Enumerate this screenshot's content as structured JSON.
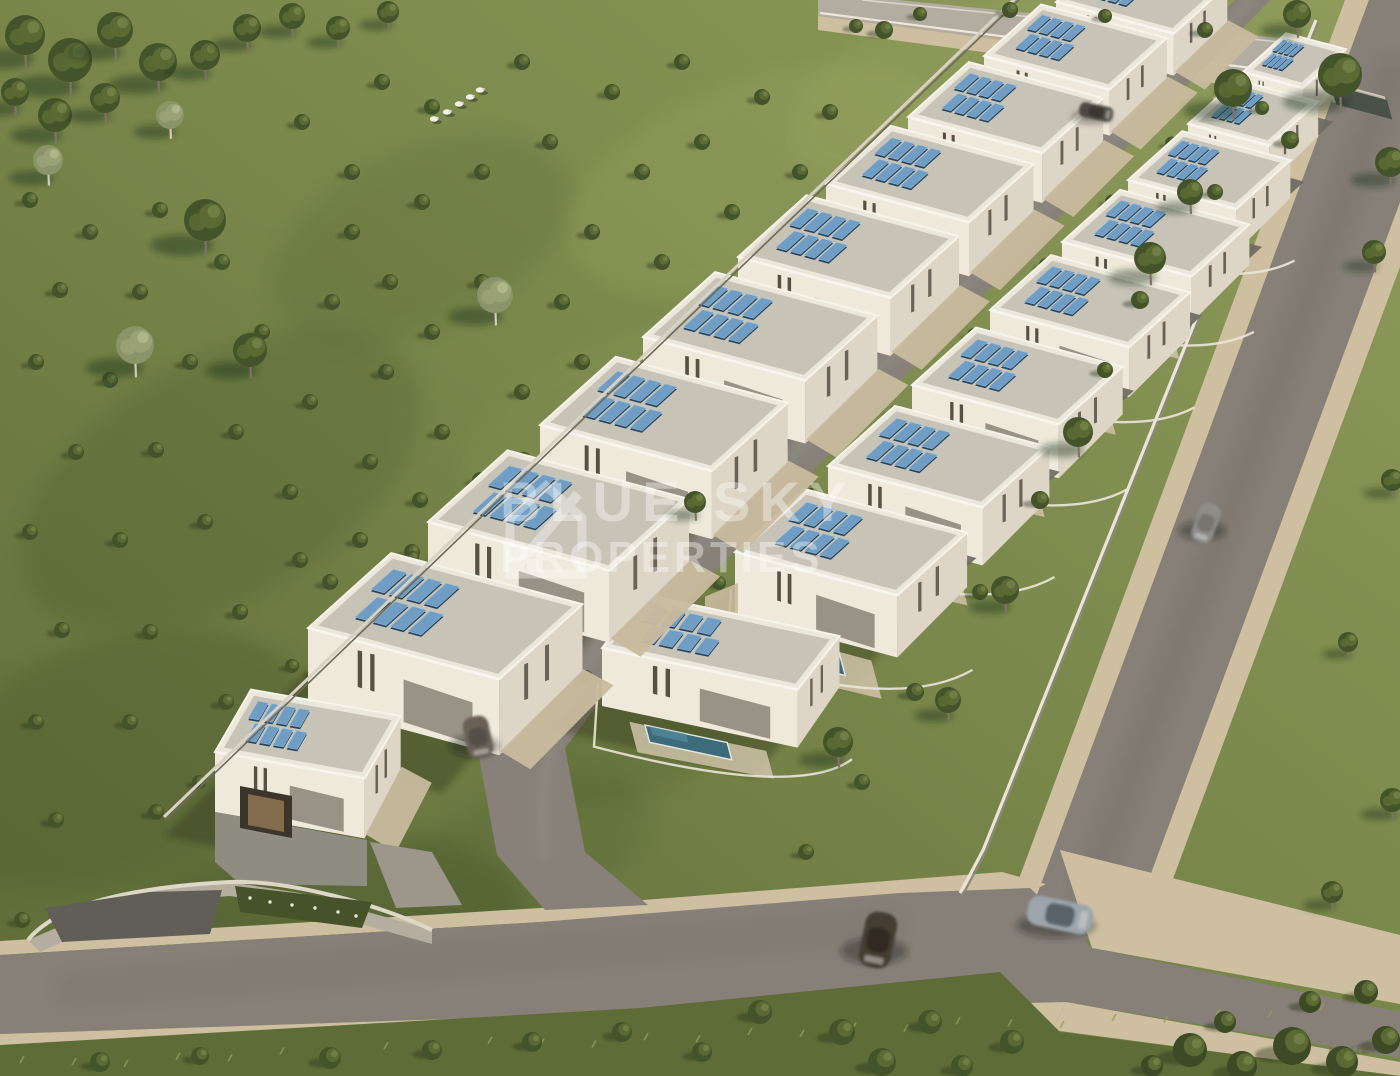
{
  "watermark": {
    "line1": "BLUE SKY",
    "line2": "PROPERTIES",
    "signature": "Uo /12"
  },
  "scene": {
    "colors": {
      "grass": "#7b894c",
      "grass_dark": "#55652f",
      "grass_light": "#97a263",
      "asphalt": "#868078",
      "asphalt_dark": "#746e66",
      "top_road": "#b3ada1",
      "sidewalk": "#cdbfa0",
      "driveway": "#c8bb9e",
      "facade": "#efe9db",
      "facade_side": "#ddd5c6",
      "roof_inner": "#c7c3b7",
      "parapet": "#f6f3eb",
      "solar_dark": "#26455f",
      "solar_light": "#6f9dc4",
      "pool": "#3c6b7c",
      "pool_light": "#5791a2",
      "wall": "#eae5d8",
      "shadow": "rgba(44,52,30,0.38)",
      "window": "#575044",
      "glass": "#7c766b",
      "tree_dark": "#44542a",
      "tree_mid": "#5b6a33",
      "tree_light": "#74834a",
      "birch": "#9aa275"
    },
    "villas_left": [
      {
        "x": 215,
        "y": 752,
        "L": 152,
        "S": 72,
        "h": 60,
        "au": -60,
        "av": 10,
        "corner": true
      },
      {
        "x": 308,
        "y": 628,
        "L": 198,
        "S": 112,
        "h": 76
      },
      {
        "x": 428,
        "y": 522,
        "L": 188,
        "S": 107,
        "h": 72
      },
      {
        "x": 540,
        "y": 425,
        "L": 178,
        "S": 102,
        "h": 68
      },
      {
        "x": 643,
        "y": 337,
        "L": 168,
        "S": 97,
        "h": 63
      },
      {
        "x": 738,
        "y": 257,
        "L": 158,
        "S": 92,
        "h": 58
      },
      {
        "x": 826,
        "y": 184,
        "L": 148,
        "S": 87,
        "h": 54
      },
      {
        "x": 908,
        "y": 117,
        "L": 139,
        "S": 82,
        "h": 50
      },
      {
        "x": 984,
        "y": 56,
        "L": 130,
        "S": 77,
        "h": 46
      },
      {
        "x": 1056,
        "y": 2,
        "L": 122,
        "S": 72,
        "h": 42
      }
    ],
    "villas_right": [
      {
        "x": 602,
        "y": 648,
        "L": 200,
        "S": 68,
        "h": 58,
        "au": -52,
        "av": 12,
        "pool": true,
        "corner": true
      },
      {
        "x": 735,
        "y": 552,
        "L": 168,
        "S": 94,
        "h": 62,
        "pool": true
      },
      {
        "x": 828,
        "y": 466,
        "L": 160,
        "S": 90,
        "h": 58,
        "pool": true
      },
      {
        "x": 912,
        "y": 385,
        "L": 152,
        "S": 86,
        "h": 54,
        "pool": true
      },
      {
        "x": 990,
        "y": 310,
        "L": 144,
        "S": 82,
        "h": 50,
        "pool": true
      },
      {
        "x": 1062,
        "y": 242,
        "L": 134,
        "S": 78,
        "h": 46,
        "pool": true
      },
      {
        "x": 1128,
        "y": 180,
        "L": 112,
        "S": 73,
        "h": 43,
        "pool": true
      },
      {
        "x": 1188,
        "y": 124,
        "L": 84,
        "S": 66,
        "h": 39
      },
      {
        "x": 1243,
        "y": 72,
        "L": 62,
        "S": 58,
        "h": 35
      }
    ],
    "carports": [
      {
        "x": 1032,
        "y": 96
      },
      {
        "x": 958,
        "y": 170
      }
    ],
    "field_trees": [
      [
        25,
        35,
        20,
        "o"
      ],
      [
        70,
        60,
        22,
        "o"
      ],
      [
        115,
        30,
        18,
        "o"
      ],
      [
        158,
        62,
        19,
        "o"
      ],
      [
        55,
        115,
        17,
        "o"
      ],
      [
        105,
        98,
        15,
        "o"
      ],
      [
        15,
        92,
        14,
        "o"
      ],
      [
        205,
        55,
        15,
        "o"
      ],
      [
        247,
        28,
        14,
        "o"
      ],
      [
        292,
        16,
        13,
        "o"
      ],
      [
        338,
        28,
        12,
        "o"
      ],
      [
        388,
        12,
        11,
        "o"
      ],
      [
        48,
        160,
        15,
        "b"
      ],
      [
        170,
        115,
        14,
        "b"
      ],
      [
        135,
        345,
        19,
        "b"
      ],
      [
        205,
        220,
        21,
        "o"
      ],
      [
        250,
        350,
        17,
        "o"
      ],
      [
        495,
        295,
        18,
        "b"
      ],
      [
        592,
        555,
        25,
        "o"
      ]
    ],
    "garden_trees": [
      [
        1233,
        88,
        19
      ],
      [
        1190,
        192,
        13
      ],
      [
        1150,
        258,
        16
      ],
      [
        1078,
        432,
        15
      ],
      [
        1005,
        590,
        14
      ],
      [
        948,
        700,
        13
      ],
      [
        838,
        742,
        15
      ],
      [
        695,
        502,
        11
      ]
    ],
    "east_trees": [
      [
        1340,
        75,
        22
      ],
      [
        1297,
        14,
        14
      ],
      [
        1390,
        162,
        15
      ],
      [
        1374,
        252,
        12
      ],
      [
        1392,
        480,
        11
      ],
      [
        1348,
        642,
        10
      ],
      [
        1392,
        800,
        12
      ],
      [
        1332,
        892,
        11
      ]
    ],
    "field_bushes": [
      [
        30,
        200
      ],
      [
        90,
        232
      ],
      [
        160,
        210
      ],
      [
        60,
        290
      ],
      [
        140,
        292
      ],
      [
        222,
        262
      ],
      [
        36,
        362
      ],
      [
        110,
        380
      ],
      [
        190,
        362
      ],
      [
        262,
        332
      ],
      [
        332,
        302
      ],
      [
        76,
        452
      ],
      [
        156,
        450
      ],
      [
        236,
        432
      ],
      [
        310,
        402
      ],
      [
        386,
        372
      ],
      [
        30,
        532
      ],
      [
        120,
        540
      ],
      [
        205,
        522
      ],
      [
        290,
        492
      ],
      [
        370,
        462
      ],
      [
        442,
        432
      ],
      [
        62,
        630
      ],
      [
        150,
        632
      ],
      [
        240,
        612
      ],
      [
        330,
        582
      ],
      [
        412,
        552
      ],
      [
        36,
        722
      ],
      [
        130,
        722
      ],
      [
        226,
        702
      ],
      [
        320,
        672
      ],
      [
        56,
        820
      ],
      [
        156,
        812
      ],
      [
        250,
        790
      ],
      [
        22,
        920
      ],
      [
        120,
        912
      ],
      [
        352,
        172
      ],
      [
        422,
        202
      ],
      [
        482,
        172
      ],
      [
        550,
        142
      ],
      [
        432,
        107
      ],
      [
        302,
        122
      ],
      [
        382,
        82
      ],
      [
        522,
        62
      ],
      [
        612,
        92
      ],
      [
        682,
        62
      ],
      [
        762,
        97
      ],
      [
        642,
        172
      ],
      [
        702,
        142
      ],
      [
        592,
        232
      ],
      [
        662,
        262
      ],
      [
        732,
        212
      ],
      [
        800,
        172
      ],
      [
        830,
        112
      ],
      [
        762,
        302
      ],
      [
        820,
        262
      ],
      [
        702,
        332
      ],
      [
        642,
        392
      ],
      [
        582,
        362
      ],
      [
        522,
        392
      ],
      [
        562,
        302
      ],
      [
        482,
        282
      ],
      [
        432,
        332
      ],
      [
        390,
        282
      ],
      [
        352,
        232
      ],
      [
        480,
        480
      ],
      [
        420,
        500
      ],
      [
        360,
        540
      ],
      [
        300,
        560
      ]
    ],
    "bottom_bushes": [
      [
        100,
        1062,
        10
      ],
      [
        200,
        1056,
        9
      ],
      [
        330,
        1058,
        11
      ],
      [
        432,
        1050,
        10
      ],
      [
        532,
        1042,
        10
      ],
      [
        622,
        1032,
        10
      ],
      [
        760,
        1012,
        12
      ],
      [
        842,
        1032,
        13
      ],
      [
        930,
        1022,
        12
      ],
      [
        1012,
        1042,
        12
      ],
      [
        882,
        1062,
        14
      ],
      [
        962,
        1066,
        11
      ],
      [
        702,
        1052,
        10
      ]
    ],
    "corner_bushes": [
      [
        1190,
        1050,
        17
      ],
      [
        1242,
        1066,
        15
      ],
      [
        1292,
        1046,
        19
      ],
      [
        1342,
        1062,
        16
      ],
      [
        1386,
        1040,
        14
      ],
      [
        1366,
        992,
        12
      ],
      [
        1310,
        1002,
        11
      ],
      [
        1225,
        1022,
        11
      ],
      [
        1152,
        1066,
        11
      ]
    ],
    "top_bushes": [
      [
        884,
        30,
        9
      ],
      [
        856,
        26,
        7
      ],
      [
        920,
        14,
        7
      ],
      [
        1010,
        10,
        8
      ],
      [
        1105,
        16,
        7
      ],
      [
        1205,
        30,
        8
      ]
    ],
    "garden_bushes": [
      [
        1290,
        140,
        9
      ],
      [
        1215,
        192,
        8
      ],
      [
        1140,
        300,
        9
      ],
      [
        1105,
        370,
        8
      ],
      [
        1040,
        500,
        9
      ],
      [
        980,
        592,
        8
      ],
      [
        915,
        692,
        9
      ],
      [
        862,
        782,
        8
      ],
      [
        806,
        852,
        8
      ],
      [
        1262,
        108,
        7
      ]
    ],
    "sheep": [
      [
        434,
        119
      ],
      [
        447,
        112
      ],
      [
        459,
        104
      ],
      [
        470,
        97
      ],
      [
        480,
        90
      ]
    ],
    "cars": [
      {
        "x": 478,
        "y": 737,
        "w": 42,
        "h": 26,
        "angle": 78,
        "color": "#6b6057",
        "roof": "#57504a"
      },
      {
        "x": 1206,
        "y": 523,
        "w": 40,
        "h": 22,
        "angle": 110,
        "color": "#8f8d8a",
        "roof": "#767470"
      },
      {
        "x": 878,
        "y": 940,
        "w": 56,
        "h": 32,
        "angle": 102,
        "color": "#453d33",
        "roof": "#332c24"
      },
      {
        "x": 1060,
        "y": 915,
        "w": 66,
        "h": 30,
        "angle": 12,
        "color": "#9ba5ab",
        "roof": "#5a646c"
      },
      {
        "x": 1096,
        "y": 112,
        "w": 34,
        "h": 15,
        "angle": 12,
        "color": "#4e4a44",
        "roof": "#3a3733"
      }
    ],
    "planter": {
      "x": 1328,
      "y": 82
    }
  }
}
